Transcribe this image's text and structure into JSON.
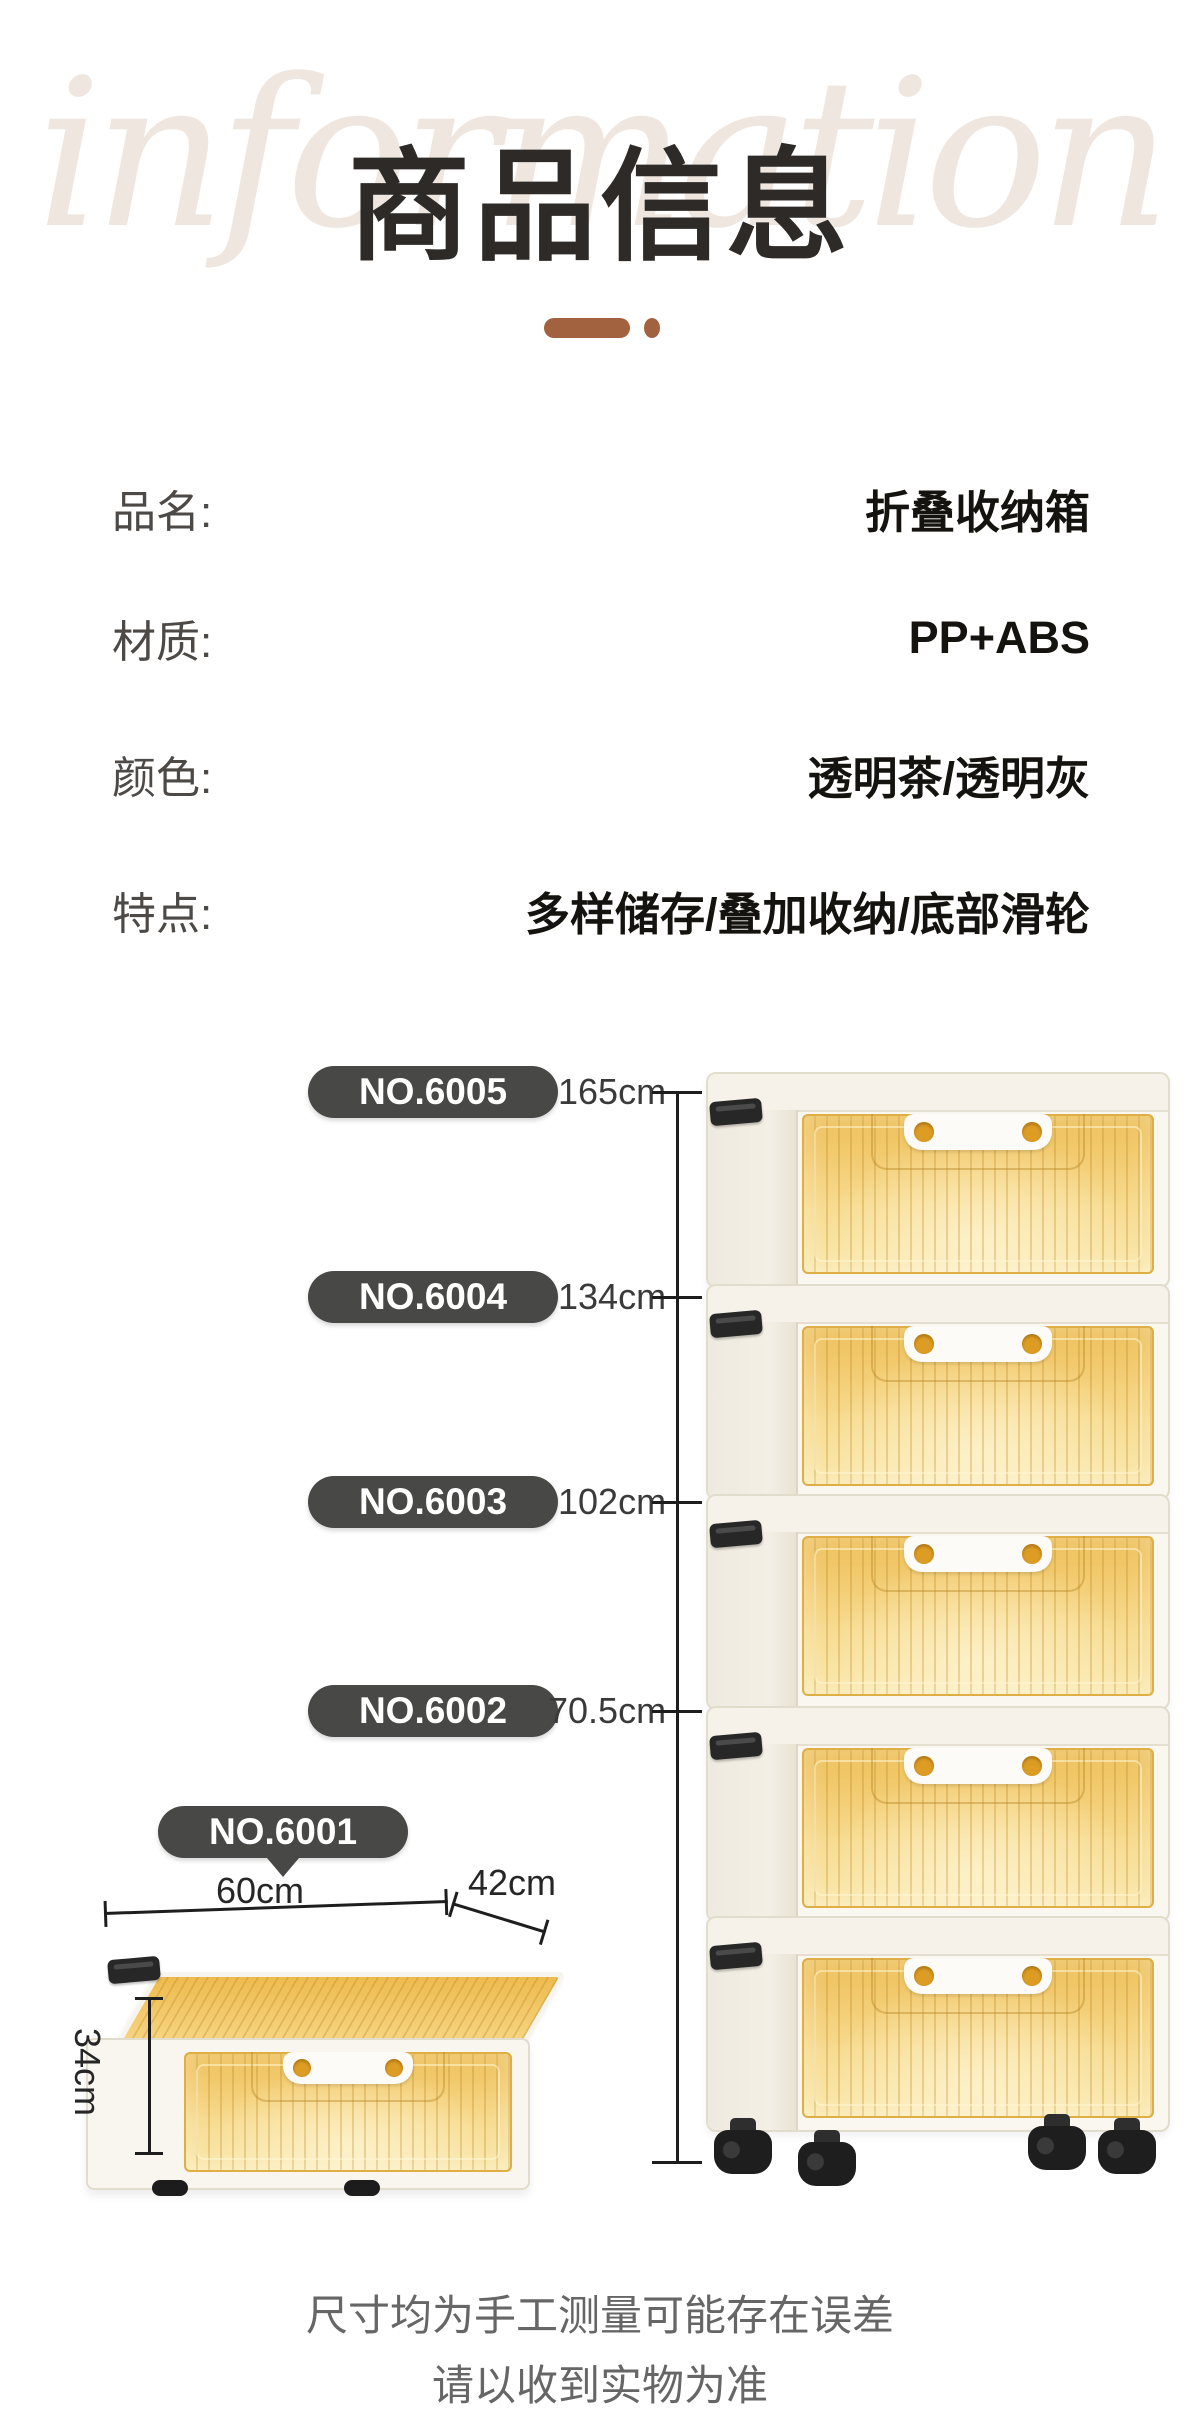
{
  "header": {
    "watermark": "information",
    "title": "商品信息"
  },
  "specs": {
    "rows": [
      {
        "label": "品名:",
        "value": "折叠收纳箱"
      },
      {
        "label": "材质:",
        "value": "PP+ABS"
      },
      {
        "label": "颜色:",
        "value": "透明茶/透明灰"
      },
      {
        "label": "特点:",
        "value": "多样储存/叠加收纳/底部滑轮"
      }
    ]
  },
  "size_diagram": {
    "models": [
      {
        "no": "NO.6005",
        "height": "165cm"
      },
      {
        "no": "NO.6004",
        "height": "134cm"
      },
      {
        "no": "NO.6003",
        "height": "102cm"
      },
      {
        "no": "NO.6002",
        "height": "70.5cm"
      },
      {
        "no": "NO.6001",
        "height": ""
      }
    ],
    "single_box": {
      "width": "60cm",
      "depth": "42cm",
      "height": "34cm"
    }
  },
  "footnote": {
    "line1": "尺寸均为手工测量可能存在误差",
    "line2": "请以收到实物为准"
  },
  "colors": {
    "accent_brown": "#a2613f",
    "badge_bg": "#484847",
    "panel_amber": "#f3cd74",
    "watermark": "#efe7df"
  }
}
